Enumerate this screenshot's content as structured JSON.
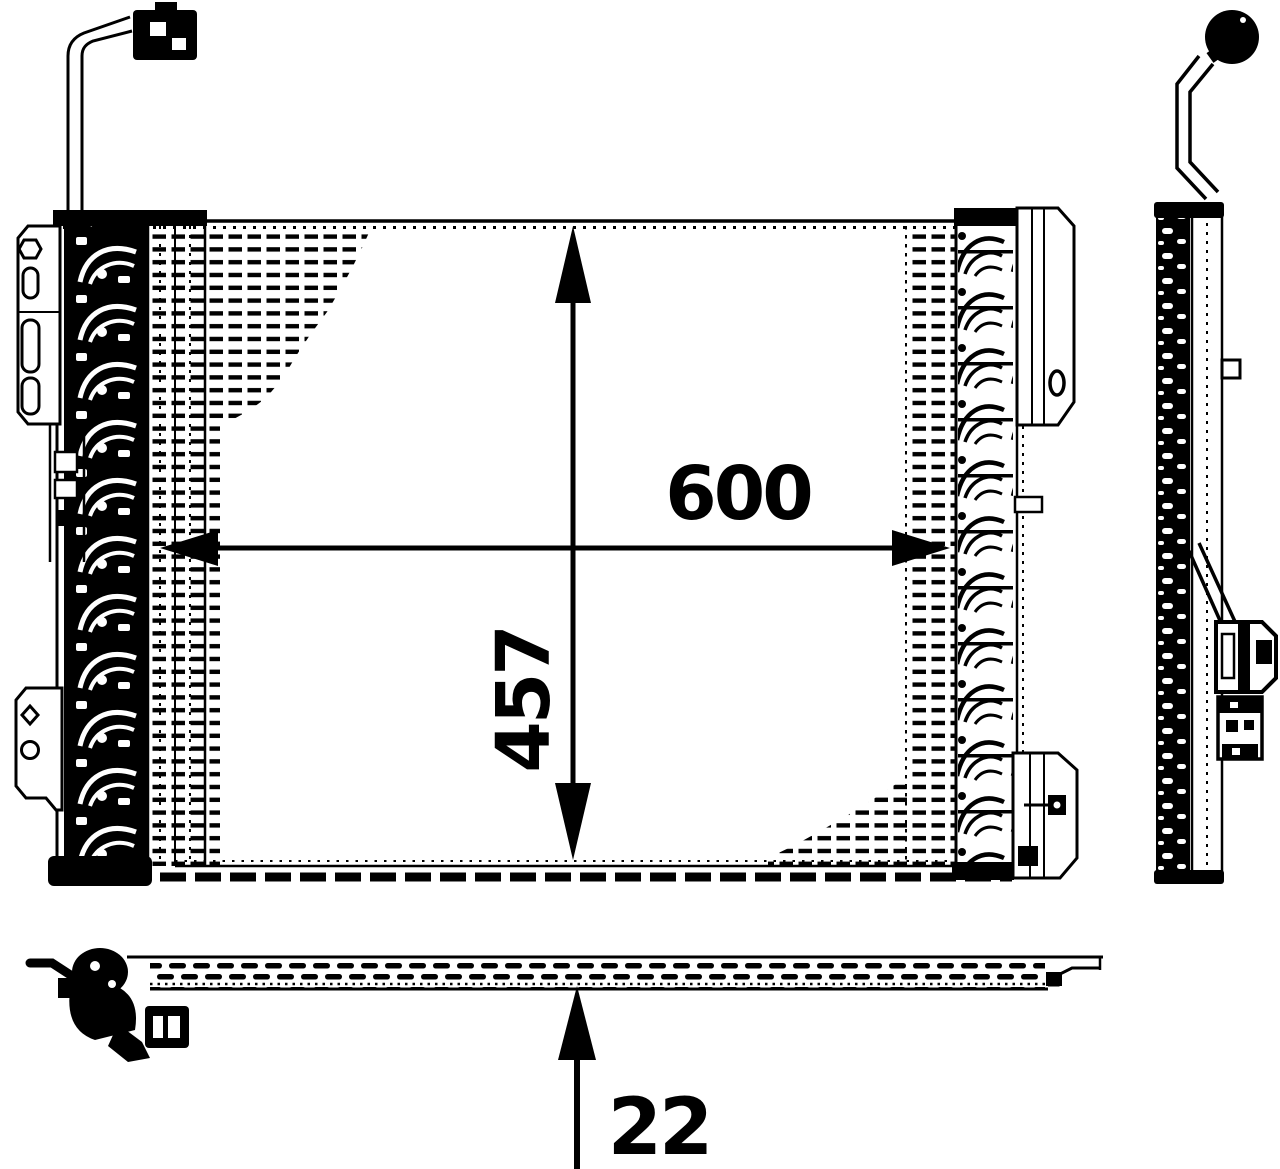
{
  "dimensions": {
    "width": "600",
    "height": "457",
    "depth": "22"
  },
  "colors": {
    "ink": "#000000",
    "paper": "#ffffff"
  }
}
